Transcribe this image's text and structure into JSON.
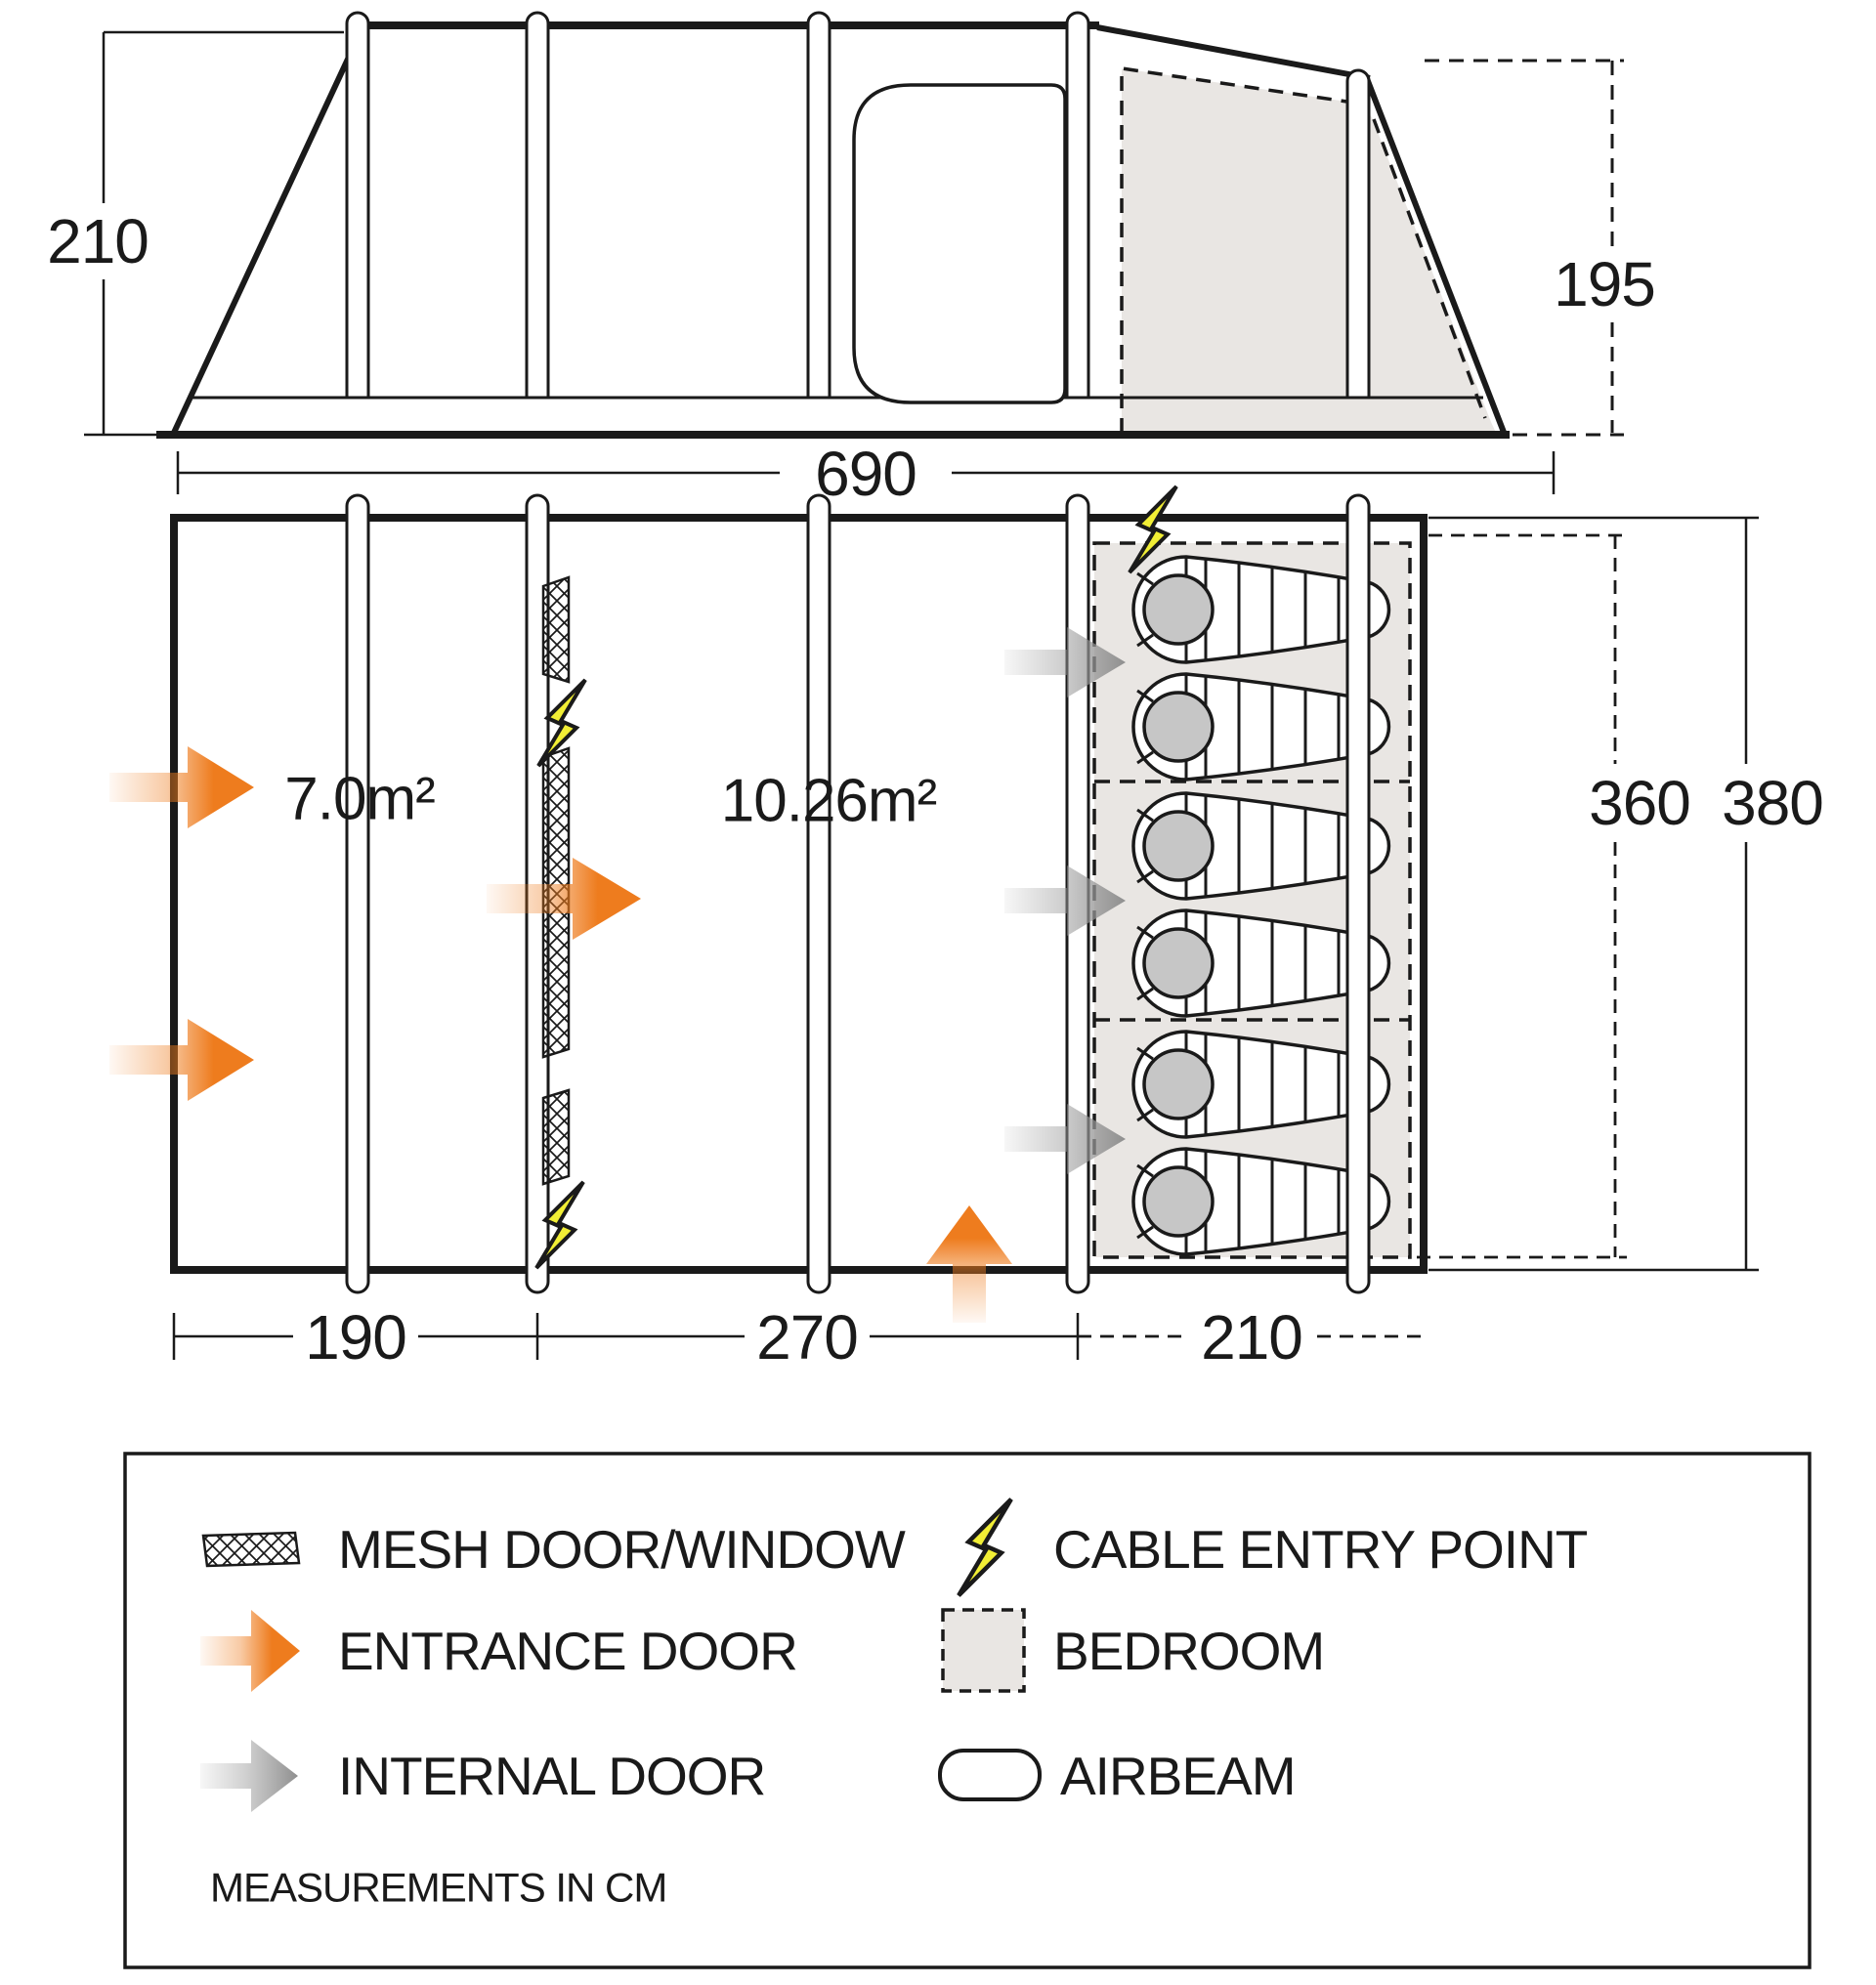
{
  "elevation": {
    "height_cm": "210",
    "bedroom_height_cm": "195"
  },
  "floorplan": {
    "total_length_cm": "690",
    "porch_area": "7.0m²",
    "living_area": "10.26m²",
    "width_inner_cm": "360",
    "width_outer_cm": "380",
    "porch_length_cm": "190",
    "living_length_cm": "270",
    "bedroom_length_cm": "210",
    "sleeping_bag_count": 6,
    "bedroom_compartments": 3
  },
  "legend": {
    "mesh_label": "MESH DOOR/WINDOW",
    "cable_label": "CABLE ENTRY POINT",
    "entrance_label": "ENTRANCE DOOR",
    "bedroom_label": "BEDROOM",
    "internal_label": "INTERNAL DOOR",
    "airbeam_label": "AIRBEAM",
    "note": "MEASUREMENTS IN CM"
  },
  "colors": {
    "line": "#1a1a1a",
    "entrance_orange": "#ee7c1e",
    "cable_yellow": "#f1ee35",
    "bedroom_gray": "#e9e6e3",
    "hood_gray": "#c6c6c6",
    "internal_gray": "#8f8f8f"
  }
}
